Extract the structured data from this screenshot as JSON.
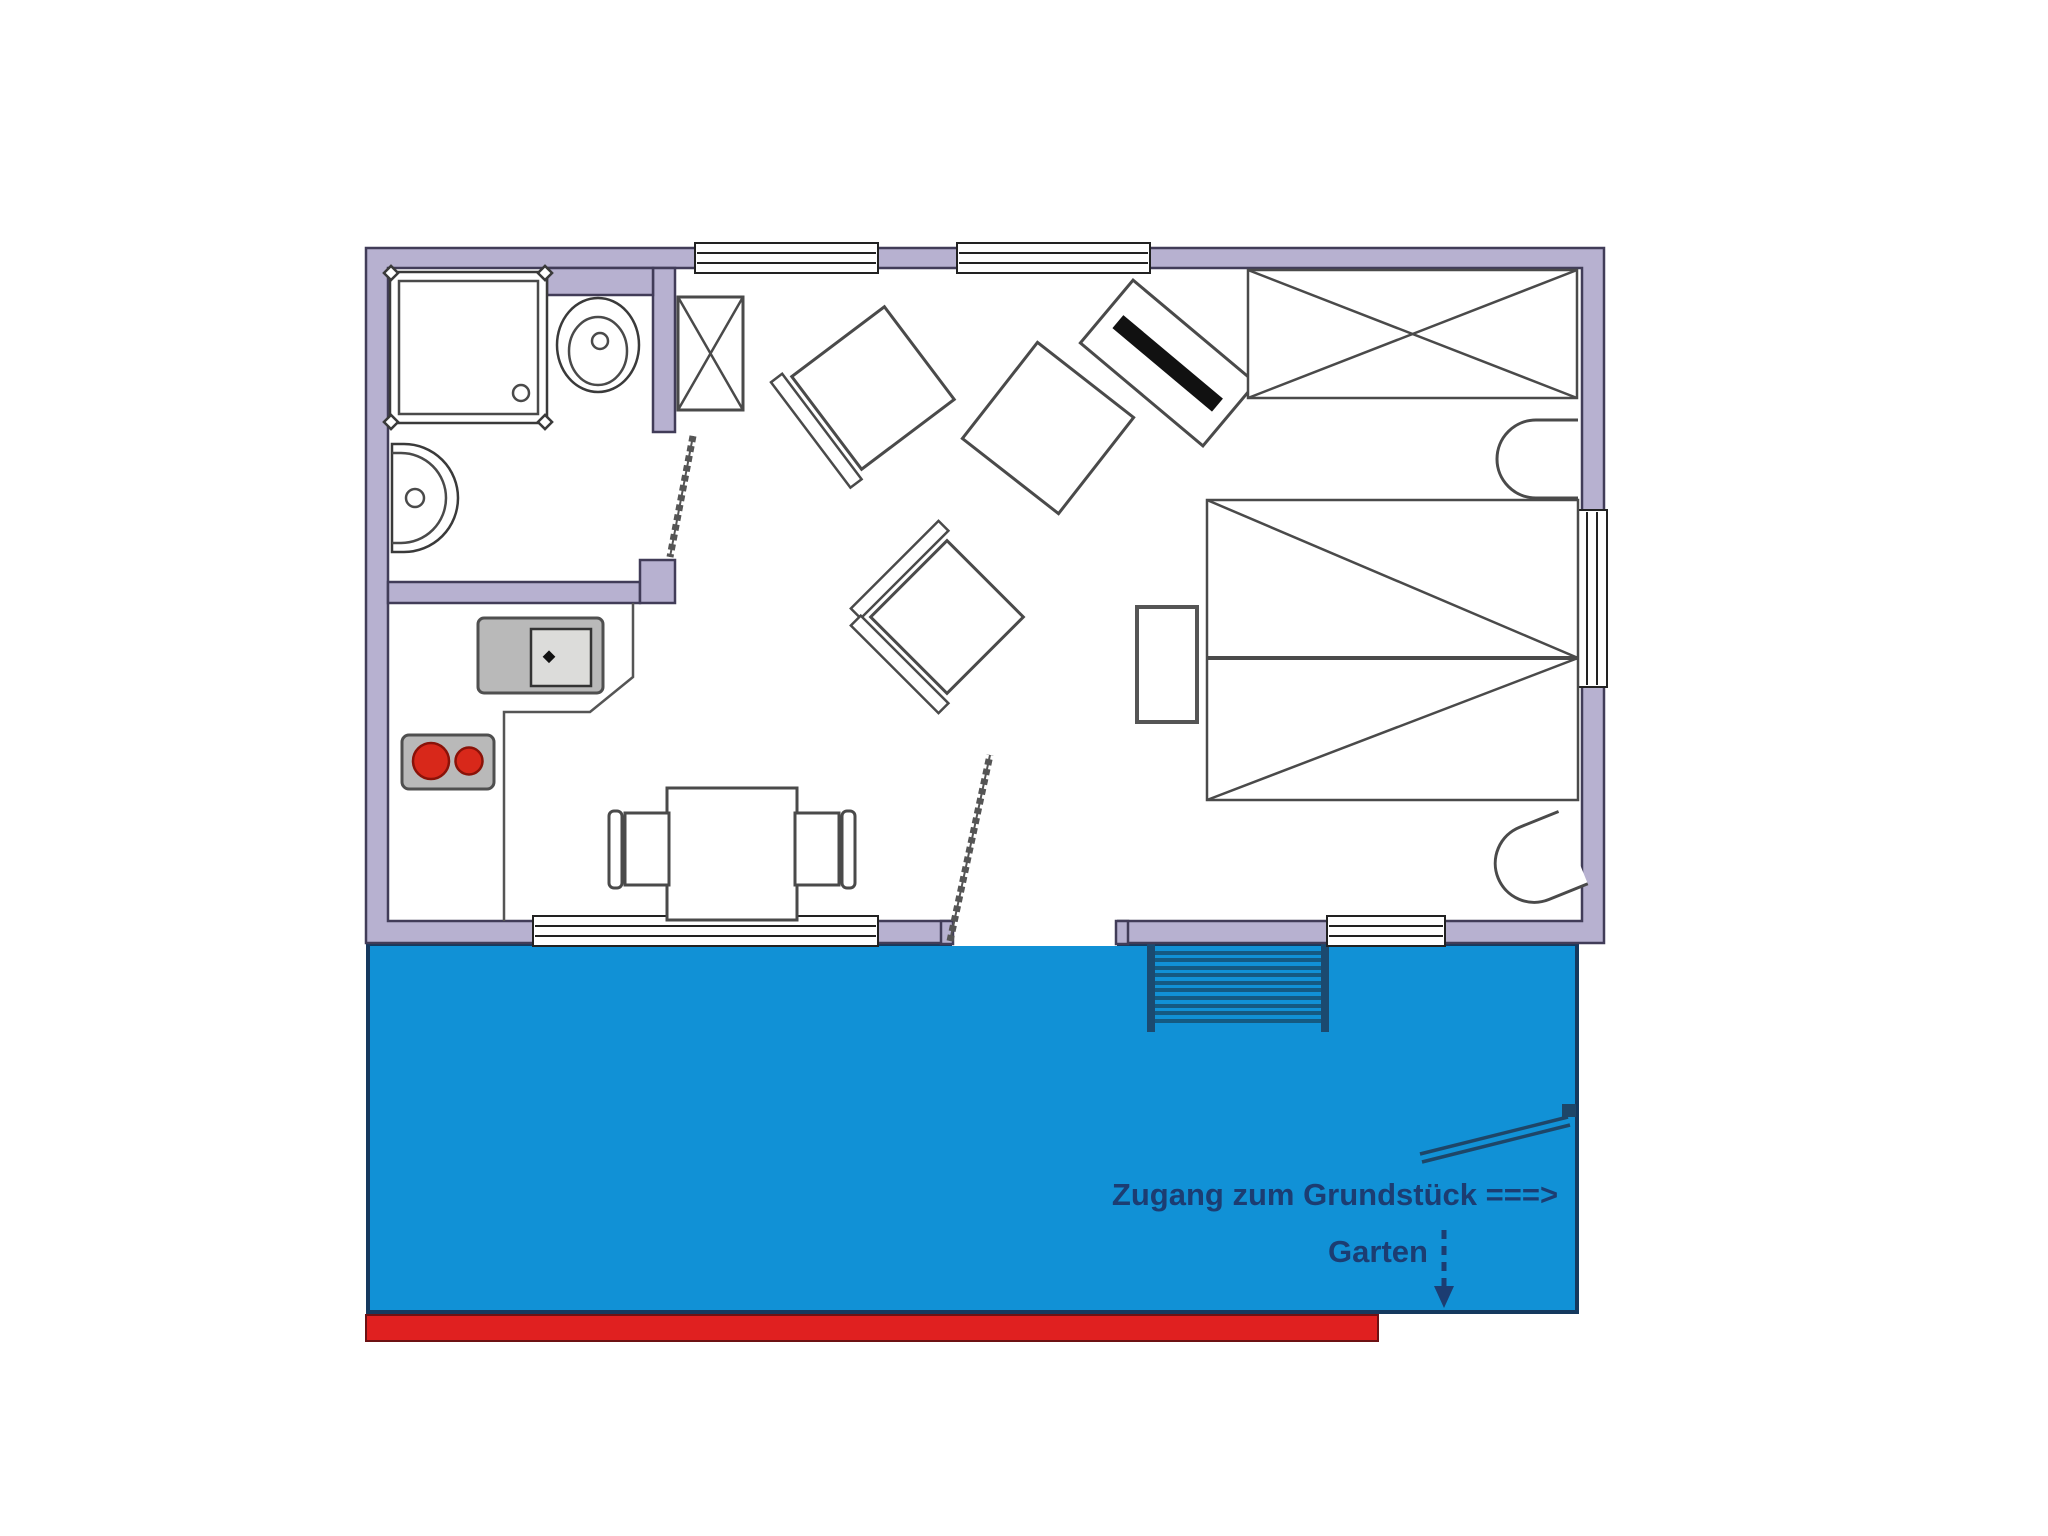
{
  "page": {
    "background": "#ffffff",
    "type": "apartment floor plan drawing"
  },
  "labels": {
    "access": "Zugang zum Grundstück ===>",
    "garden": "Garten"
  },
  "colors": {
    "wall": "#b7b1d0",
    "wall_line": "#413c58",
    "terrace": "#1191d6",
    "terrace_line": "#15395e",
    "red_strip": "#e02020",
    "label_navy": "#1c3d72",
    "counter_gray": "#b9b9b9",
    "burner_red": "#d8281a"
  },
  "elements": [
    "exterior-walls",
    "windows",
    "bathroom",
    "shower",
    "toilet",
    "washbasin",
    "bathroom-door",
    "hall-closet",
    "kitchen-counter",
    "kitchen-sink",
    "stove",
    "dining-table",
    "dining-chairs",
    "armchair",
    "lounge-chair",
    "side-table",
    "tv-stand",
    "wardrobe",
    "double-bed",
    "nightstand",
    "tub-chairs",
    "entry-door",
    "terrace",
    "stairs",
    "garden-path",
    "garden-arrow",
    "red-walkway"
  ]
}
